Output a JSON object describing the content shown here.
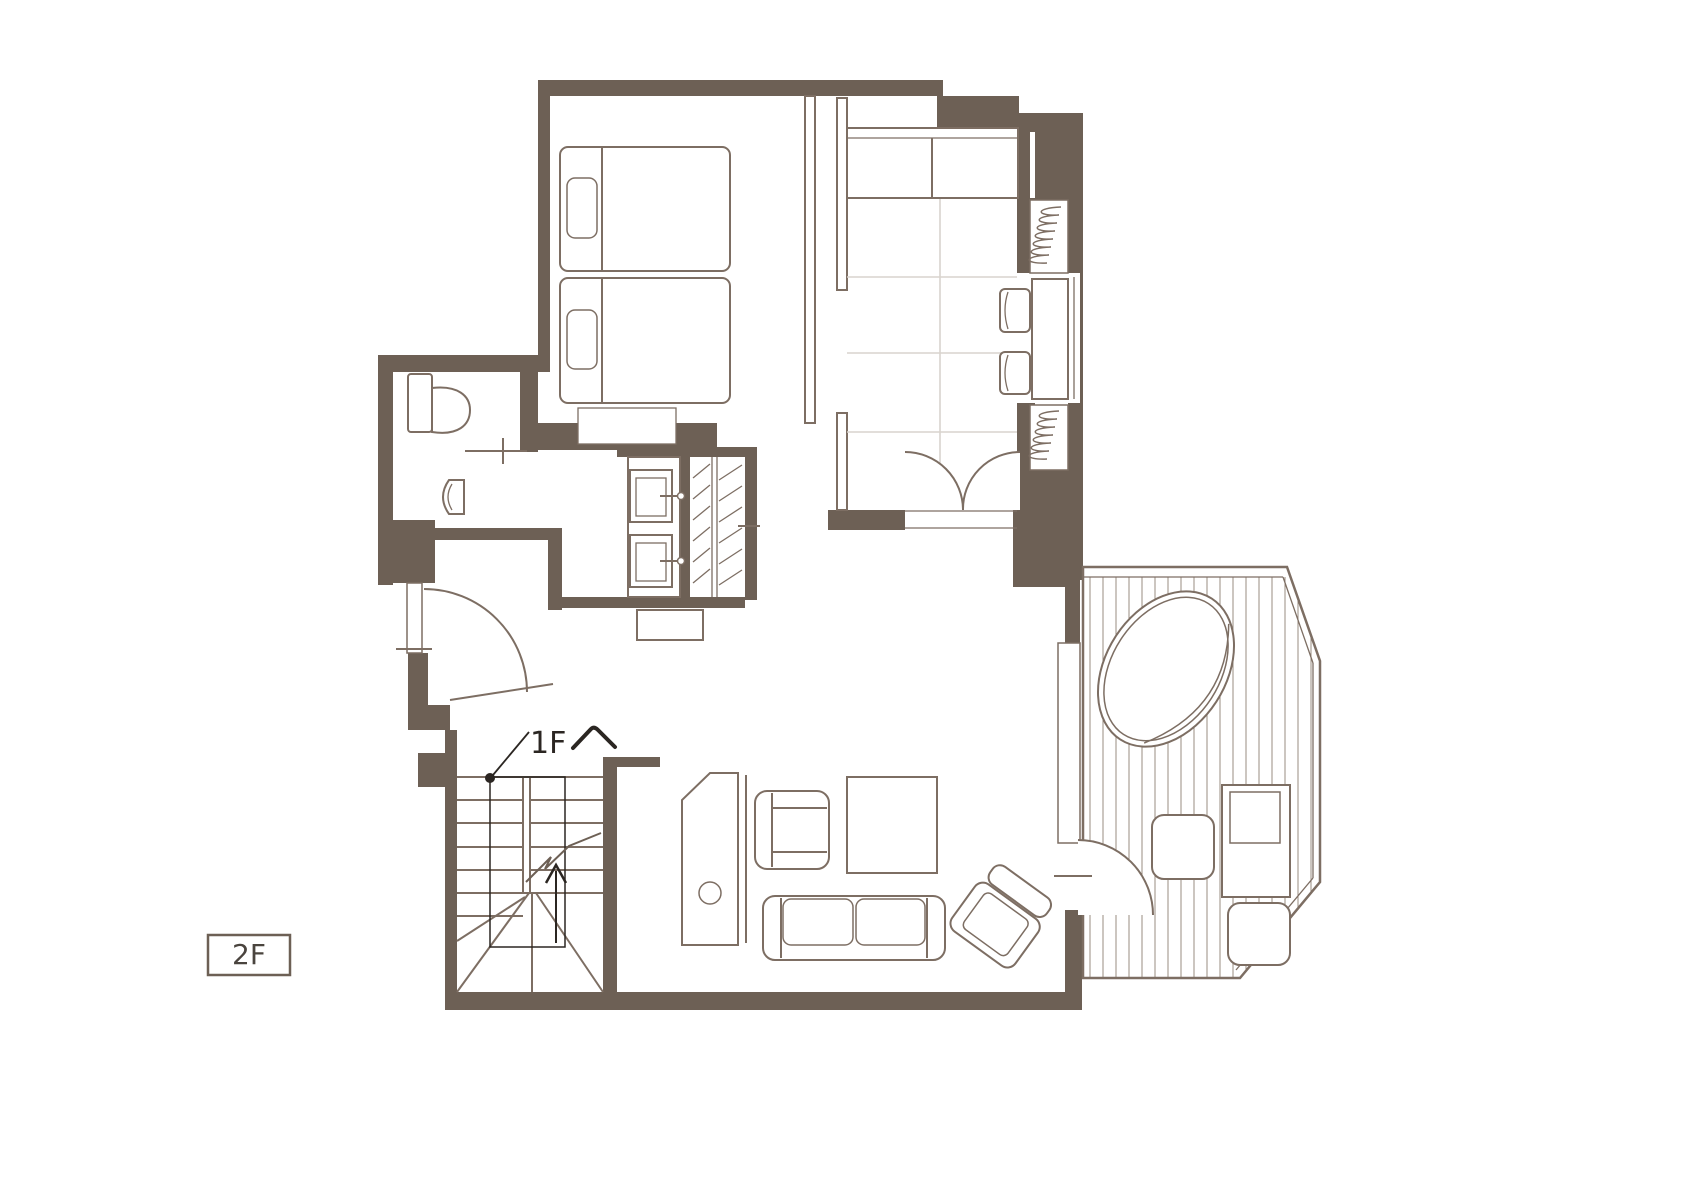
{
  "colors": {
    "wall": "#6d6055",
    "furniture_line": "#7d6e63",
    "tatami_grid": "#d9d4ce",
    "deck_plank": "#9a8c80",
    "annotation": "#2b2622",
    "badge_text": "#4a443e",
    "background": "#ffffff"
  },
  "labels": {
    "stairs_destination": "1Fへ",
    "stairs_destination_display": "1F",
    "floor_badge": "2F"
  }
}
